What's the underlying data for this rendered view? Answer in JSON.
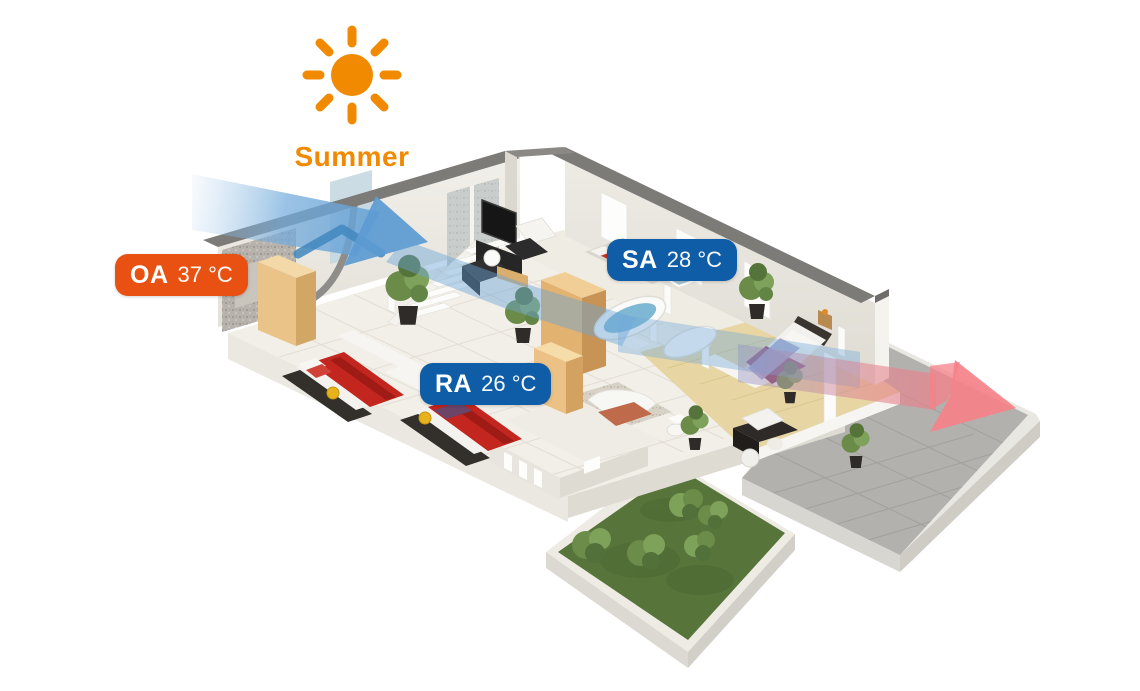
{
  "season": {
    "label": "Summer"
  },
  "badges": {
    "oa": {
      "code": "OA",
      "temperature": "37 °C"
    },
    "sa": {
      "code": "SA",
      "temperature": "28 °C"
    },
    "ra": {
      "code": "RA",
      "temperature": "26 °C"
    }
  },
  "colors": {
    "summer_orange": "#F18A00",
    "oa_badge_orange": "#E85112",
    "sa_ra_badge_blue": "#0F5CA7",
    "supply_airflow_blue": "#5C9BD2",
    "exhaust_airflow_red": "#F58289"
  },
  "icons": {
    "sun": "sun-icon",
    "supply_arrow": "supply-air-arrow",
    "exhaust_arrow": "exhaust-air-arrow"
  }
}
